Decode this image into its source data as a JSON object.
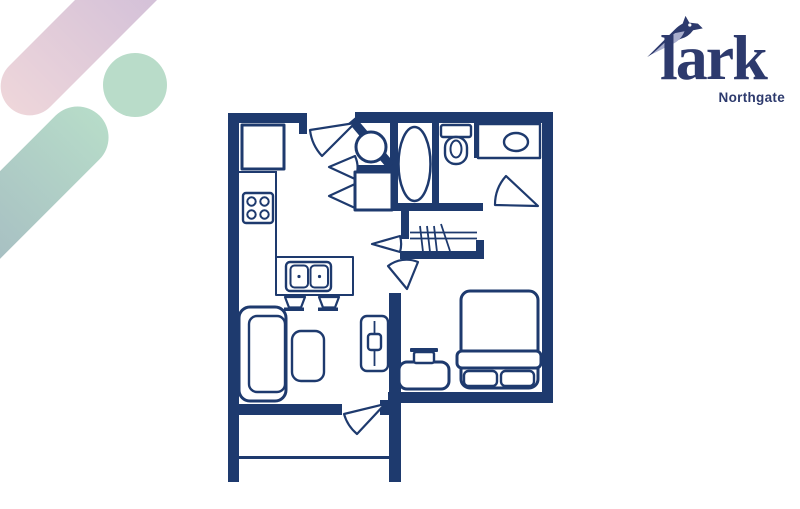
{
  "colors": {
    "navy": "#1e3a6e",
    "logo-navy": "#2d3a6d",
    "lavender": "#a9aecd",
    "pink-top": "#cbbad8",
    "pink-bottom": "#eed6da",
    "mint": "#b9dcc9",
    "teal-top": "#b7dcc9",
    "teal-bottom": "#9fb0bf",
    "background": "#ffffff"
  },
  "logo": {
    "brand": "lark",
    "location": "Northgate",
    "bird_icon": "bird-logo-icon"
  },
  "decor": {
    "shapes": [
      {
        "name": "pink-gradient-capsule",
        "angle_deg": 45
      },
      {
        "name": "mint-circle"
      },
      {
        "name": "teal-gradient-capsule",
        "angle_deg": 45
      }
    ]
  },
  "floorplan": {
    "type": "floor-plan",
    "wall_color": "#1e3a6e",
    "fixtures": [
      "refrigerator",
      "stove-cooktop",
      "kitchen-sink-peninsula",
      "bar-stool",
      "bar-stool",
      "washer",
      "dryer",
      "bathtub",
      "toilet",
      "vanity-sink",
      "closet-rod-with-hangers",
      "bed",
      "pillow",
      "pillow",
      "bench-with-lamp",
      "sofa",
      "coffee-table",
      "tv-console",
      "balcony-railing"
    ],
    "doors": [
      "entry-door",
      "laundry-door",
      "laundry-door",
      "hall-closet-door",
      "bathroom-door",
      "bedroom-door",
      "balcony-door"
    ]
  }
}
